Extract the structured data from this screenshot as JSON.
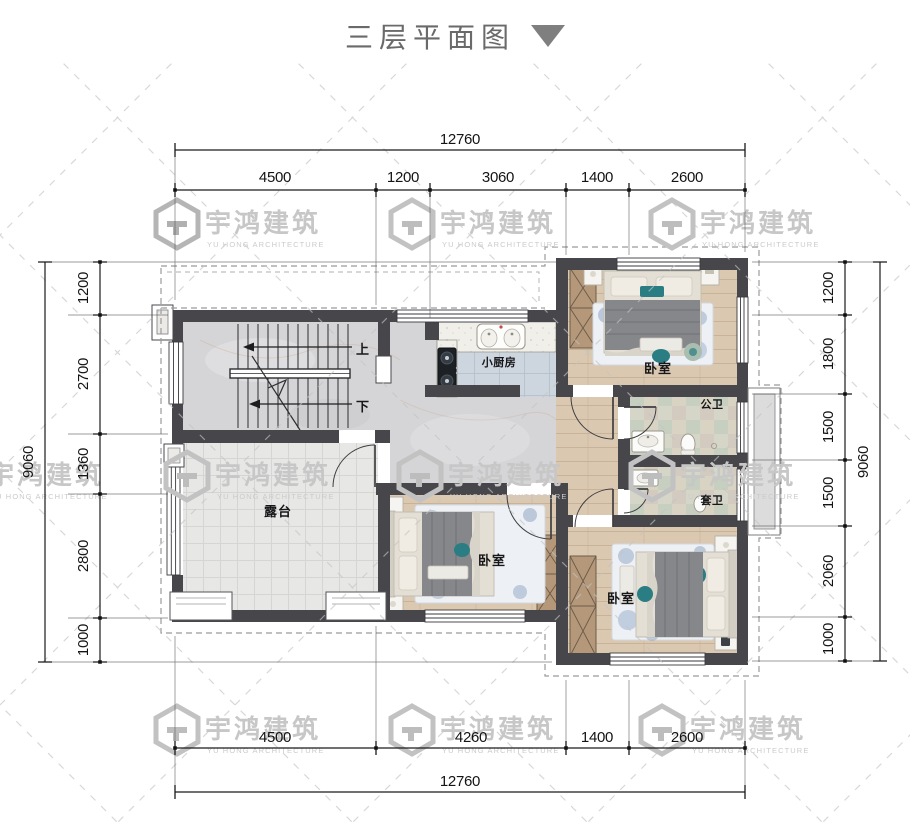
{
  "title": {
    "text": "三层平面图"
  },
  "watermark": {
    "name": "宇鸿建筑",
    "subtitle": "YU HONG ARCHITECTURE"
  },
  "plan": {
    "rooms": {
      "kitchen": "小厨房",
      "bedroom_top": "卧室",
      "bedroom_middle": "卧室",
      "bedroom_bottom": "卧室",
      "bath_public": "公卫",
      "bath_ensuite": "套卫",
      "terrace": "露台",
      "stairs_up": "上",
      "stairs_down": "下"
    }
  },
  "dimensions": {
    "top": {
      "total": "12760",
      "segments": [
        "4500",
        "1200",
        "3060",
        "1400",
        "2600"
      ]
    },
    "bottom": {
      "total": "12760",
      "segments": [
        "4500",
        "4260",
        "1400",
        "2600"
      ]
    },
    "left": {
      "total": "9060",
      "segments": [
        "1200",
        "2700",
        "1360",
        "2800",
        "1000"
      ]
    },
    "right": {
      "total": "9060",
      "segments": [
        "1200",
        "1800",
        "1500",
        "1500",
        "2060",
        "1000"
      ]
    }
  },
  "colors": {
    "wall": "#47474b",
    "accent_teal": "#2a7d82",
    "wood_floor": "#dbc8b0",
    "marble_floor": "#d5d4d6",
    "kitchen_tile": "#cdd5df",
    "terrace_tile": "#e7e7e5",
    "watermark_gray": "#c7c7c7",
    "dimension_text": "#141414"
  }
}
